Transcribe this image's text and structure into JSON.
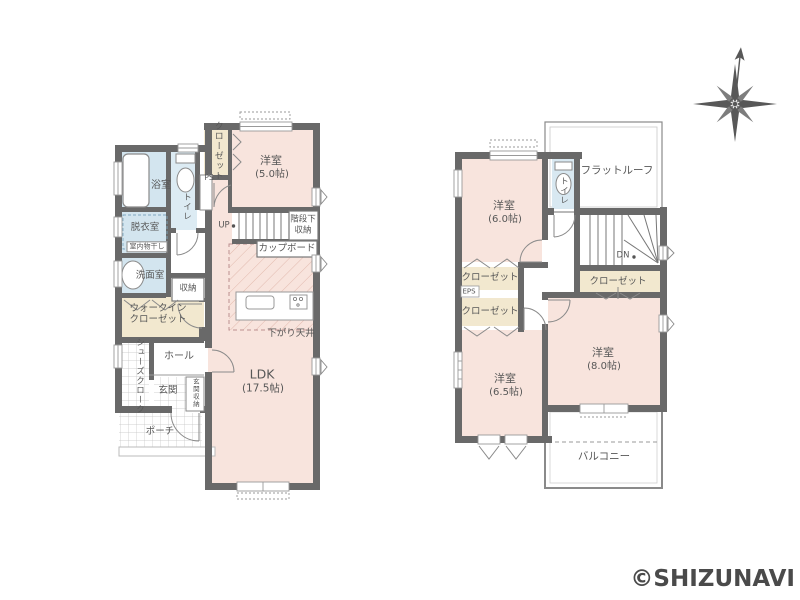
{
  "watermark": "©SHIZUNAVI",
  "floor1": {
    "closet": "クローゼット",
    "ps": "PS",
    "bedroom5_name": "洋室",
    "bedroom5_size": "(5.0帖)",
    "bath": "浴室",
    "toilet": "トイレ",
    "dressing_room": "脱衣室",
    "indoor_drying": "室内物干し",
    "washroom": "洗面室",
    "up": "UP",
    "under_stair_storage_line1": "階段下",
    "under_stair_storage_line2": "収納",
    "cupboard": "カップボード",
    "storage": "収納",
    "wic_line1": "ウォークイン",
    "wic_line2": "クローゼット",
    "lowered_ceiling": "下がり天井",
    "shoe_cloak": "シューズクローク",
    "hall": "ホール",
    "ldk_name": "LDK",
    "ldk_size": "(17.5帖)",
    "entrance": "玄関",
    "entrance_storage": "玄関収納",
    "porch": "ポーチ"
  },
  "floor2": {
    "bedroom6_name": "洋室",
    "bedroom6_size": "(6.0帖)",
    "toilet": "トイレ",
    "flat_roof": "フラットルーフ",
    "dn": "DN",
    "closet_by_stairs": "クローゼット",
    "closet_a": "クローゼット",
    "eps": "EPS",
    "closet_b": "クローゼット",
    "bedroom65_name": "洋室",
    "bedroom65_size": "(6.5帖)",
    "bedroom8_name": "洋室",
    "bedroom8_size": "(8.0帖)",
    "balcony": "バルコニー"
  },
  "colors": {
    "room_pink": "#f8e4dd",
    "room_blue": "#d3e5ef",
    "room_cream": "#f2e8cf",
    "wall_gray": "#696969",
    "text_gray": "#575757"
  }
}
